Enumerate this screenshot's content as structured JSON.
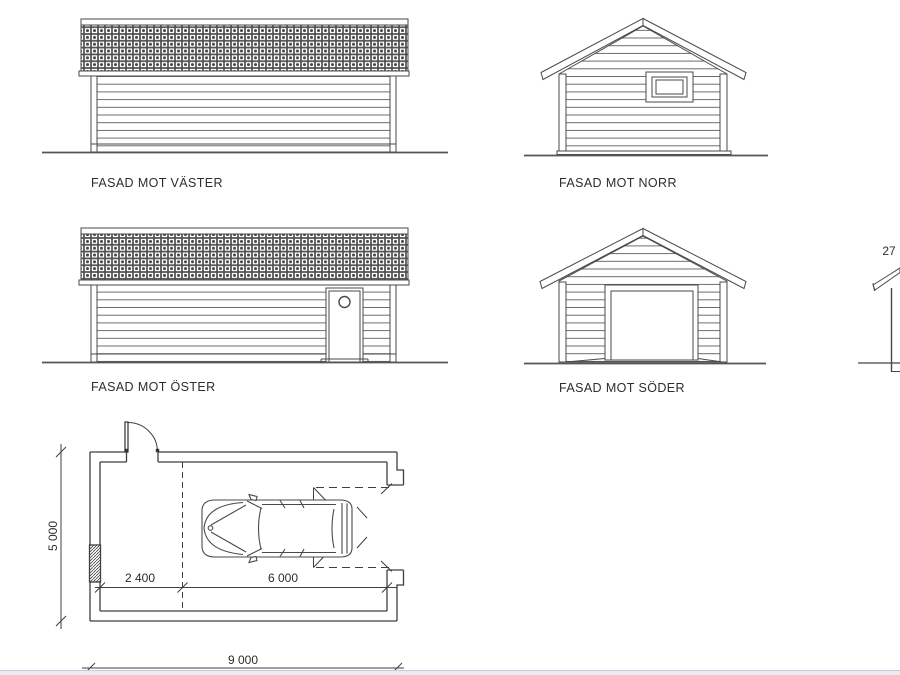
{
  "sheet": {
    "background": "#ffffff",
    "line_color": "#4a4a4a",
    "ground_line_color": "#555555",
    "text_color": "#2d2d2d",
    "footer_bar_color": "#e8ebf2"
  },
  "labels": {
    "west": "FASAD MOT VÄSTER",
    "north": "FASAD MOT NORR",
    "east": "FASAD MOT ÖSTER",
    "south": "FASAD MOT SÖDER"
  },
  "section": {
    "dimension_partial": "27"
  },
  "floor_plan": {
    "dim_depth": "5 000",
    "dim_entry_width": "2 400",
    "dim_garage_width": "6 000",
    "dim_total_width": "9 000"
  }
}
